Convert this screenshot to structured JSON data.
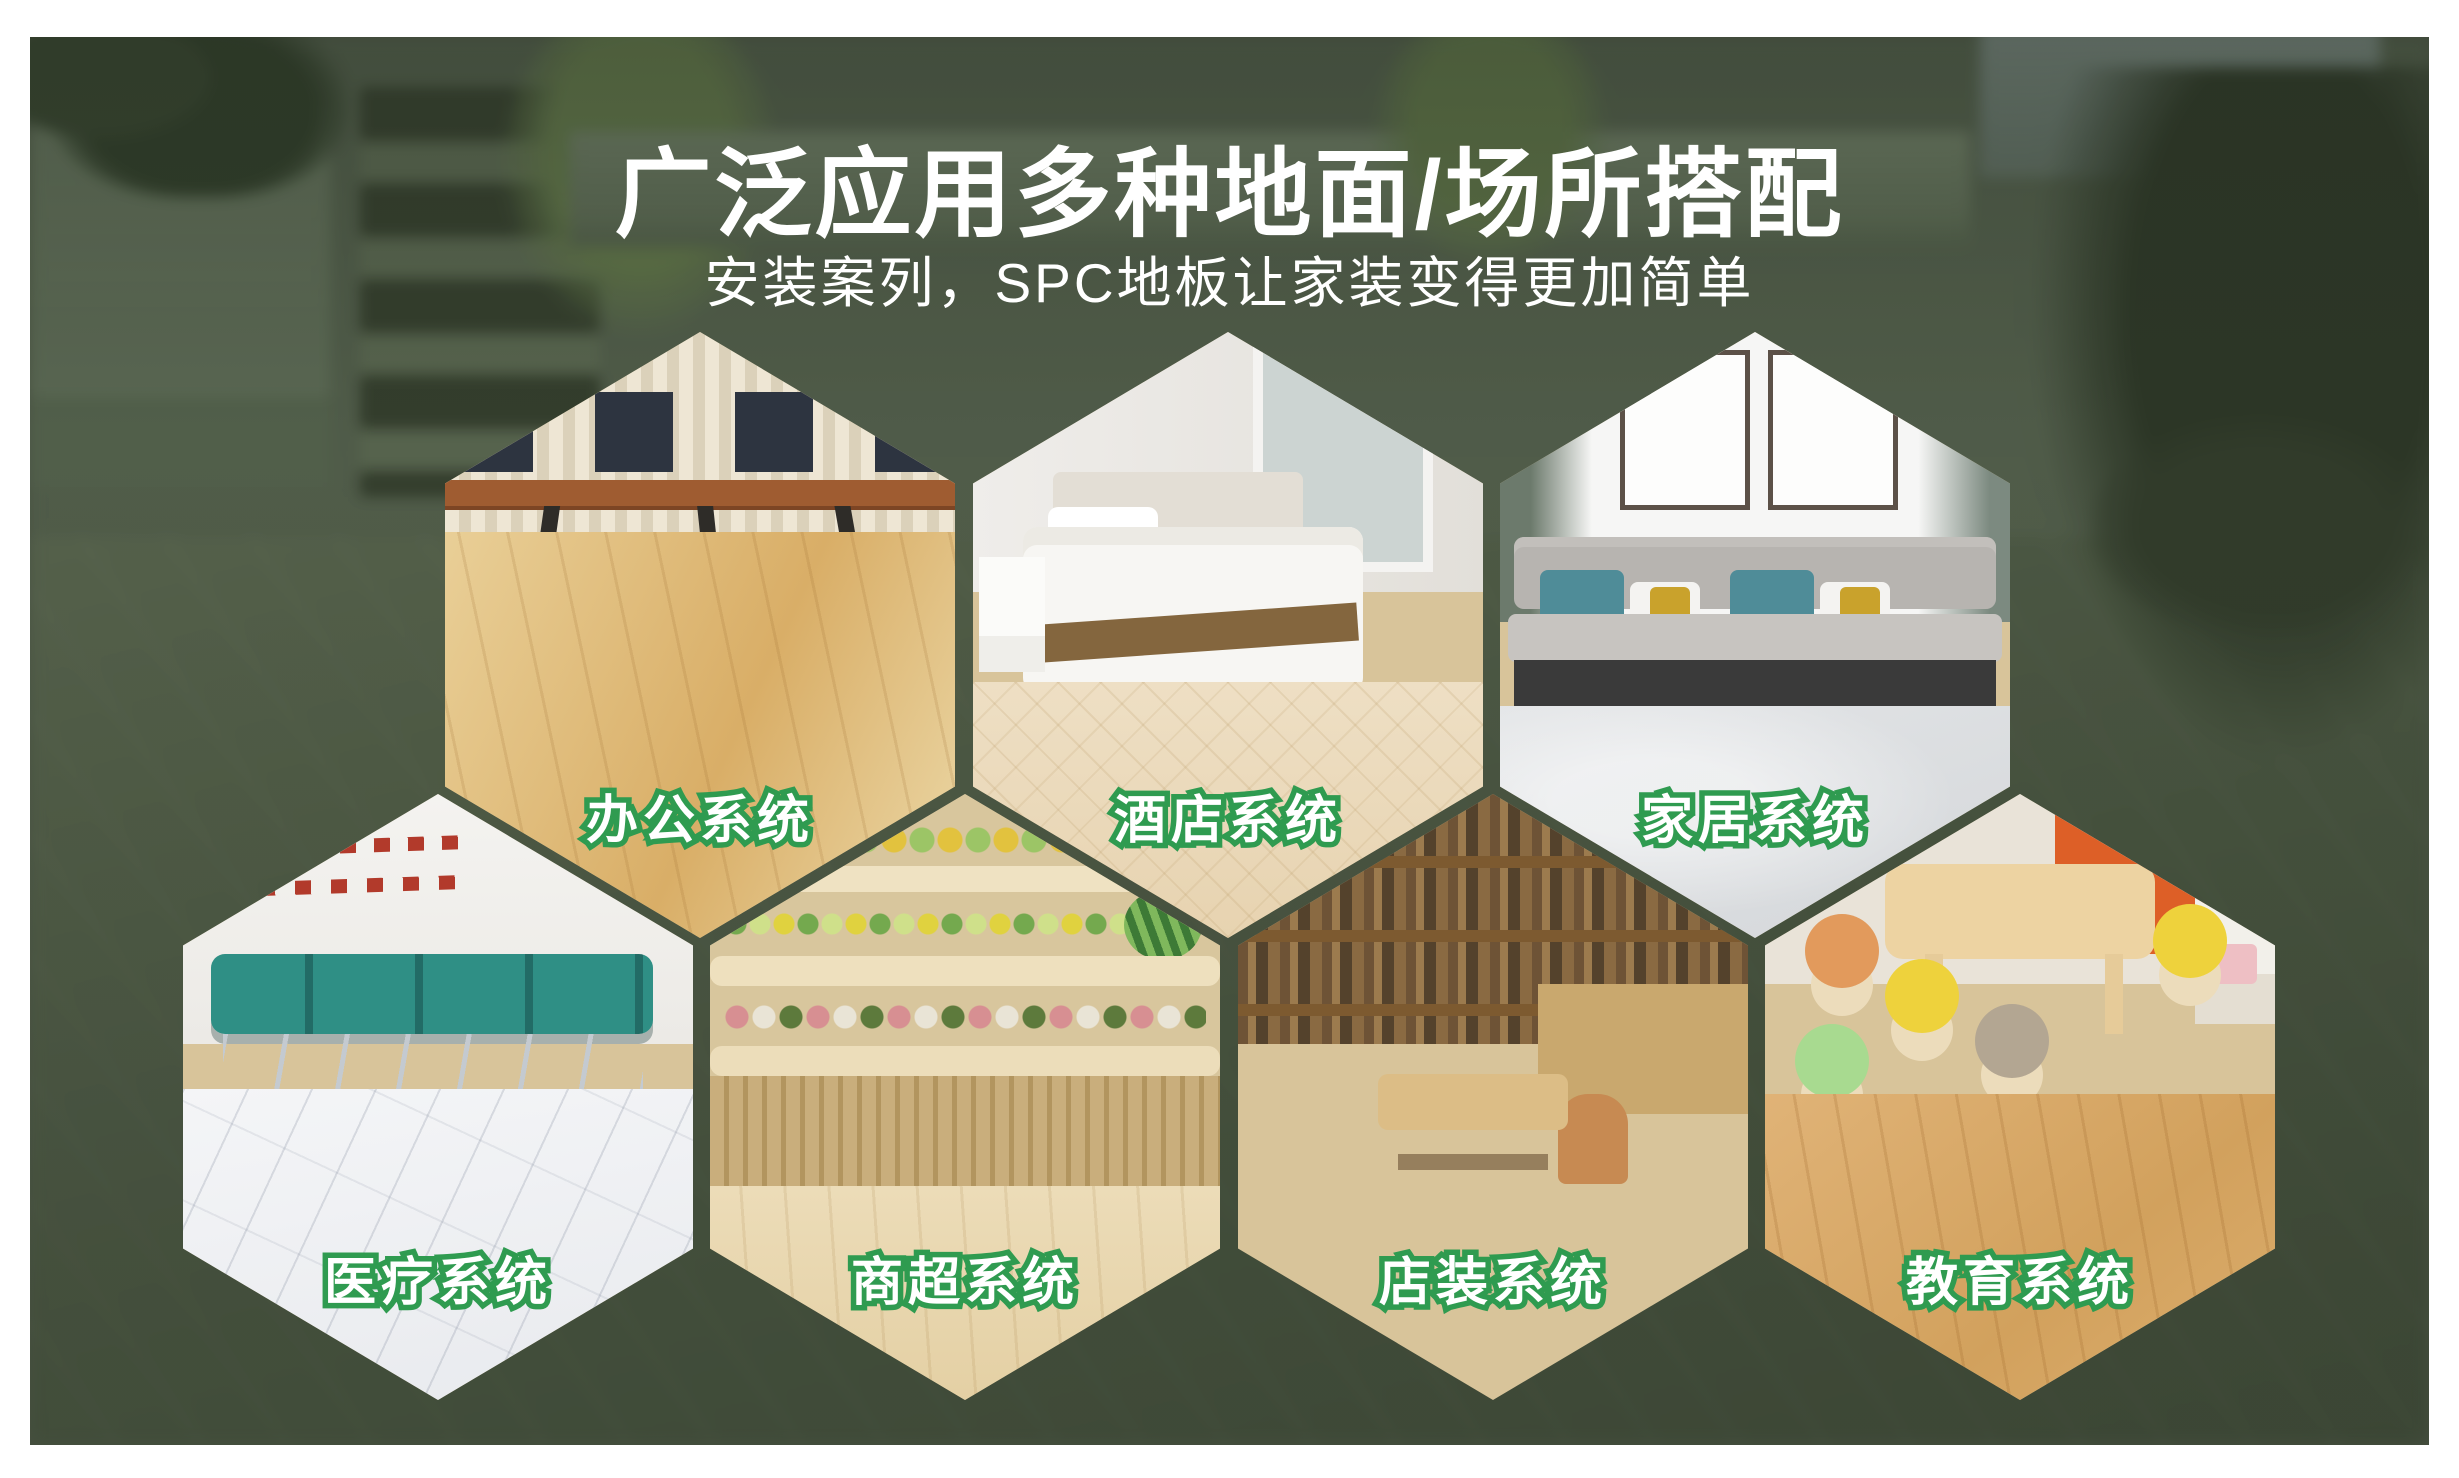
{
  "header": {
    "title": "广泛应用多种地面/场所搭配",
    "subtitle": "安装案列，SPC地板让家装变得更加简单"
  },
  "colors": {
    "accent_green": "#2f9b50",
    "banner_overlay_green": "#4a5444",
    "text_white": "#ffffff"
  },
  "hexagons": [
    {
      "label": "办公系统",
      "scene": "office-workstations-wood-floor"
    },
    {
      "label": "酒店系统",
      "scene": "hotel-bedroom-wood-floor"
    },
    {
      "label": "家居系统",
      "scene": "home-livingroom-sofa-stone-floor"
    },
    {
      "label": "医疗系统",
      "scene": "hospital-waiting-chairs-marble-floor"
    },
    {
      "label": "商超系统",
      "scene": "supermarket-produce-shelves-wood-floor"
    },
    {
      "label": "店装系统",
      "scene": "shop-bookshelf-table-parquet-floor"
    },
    {
      "label": "教育系统",
      "scene": "classroom-stools-wood-floor"
    }
  ]
}
